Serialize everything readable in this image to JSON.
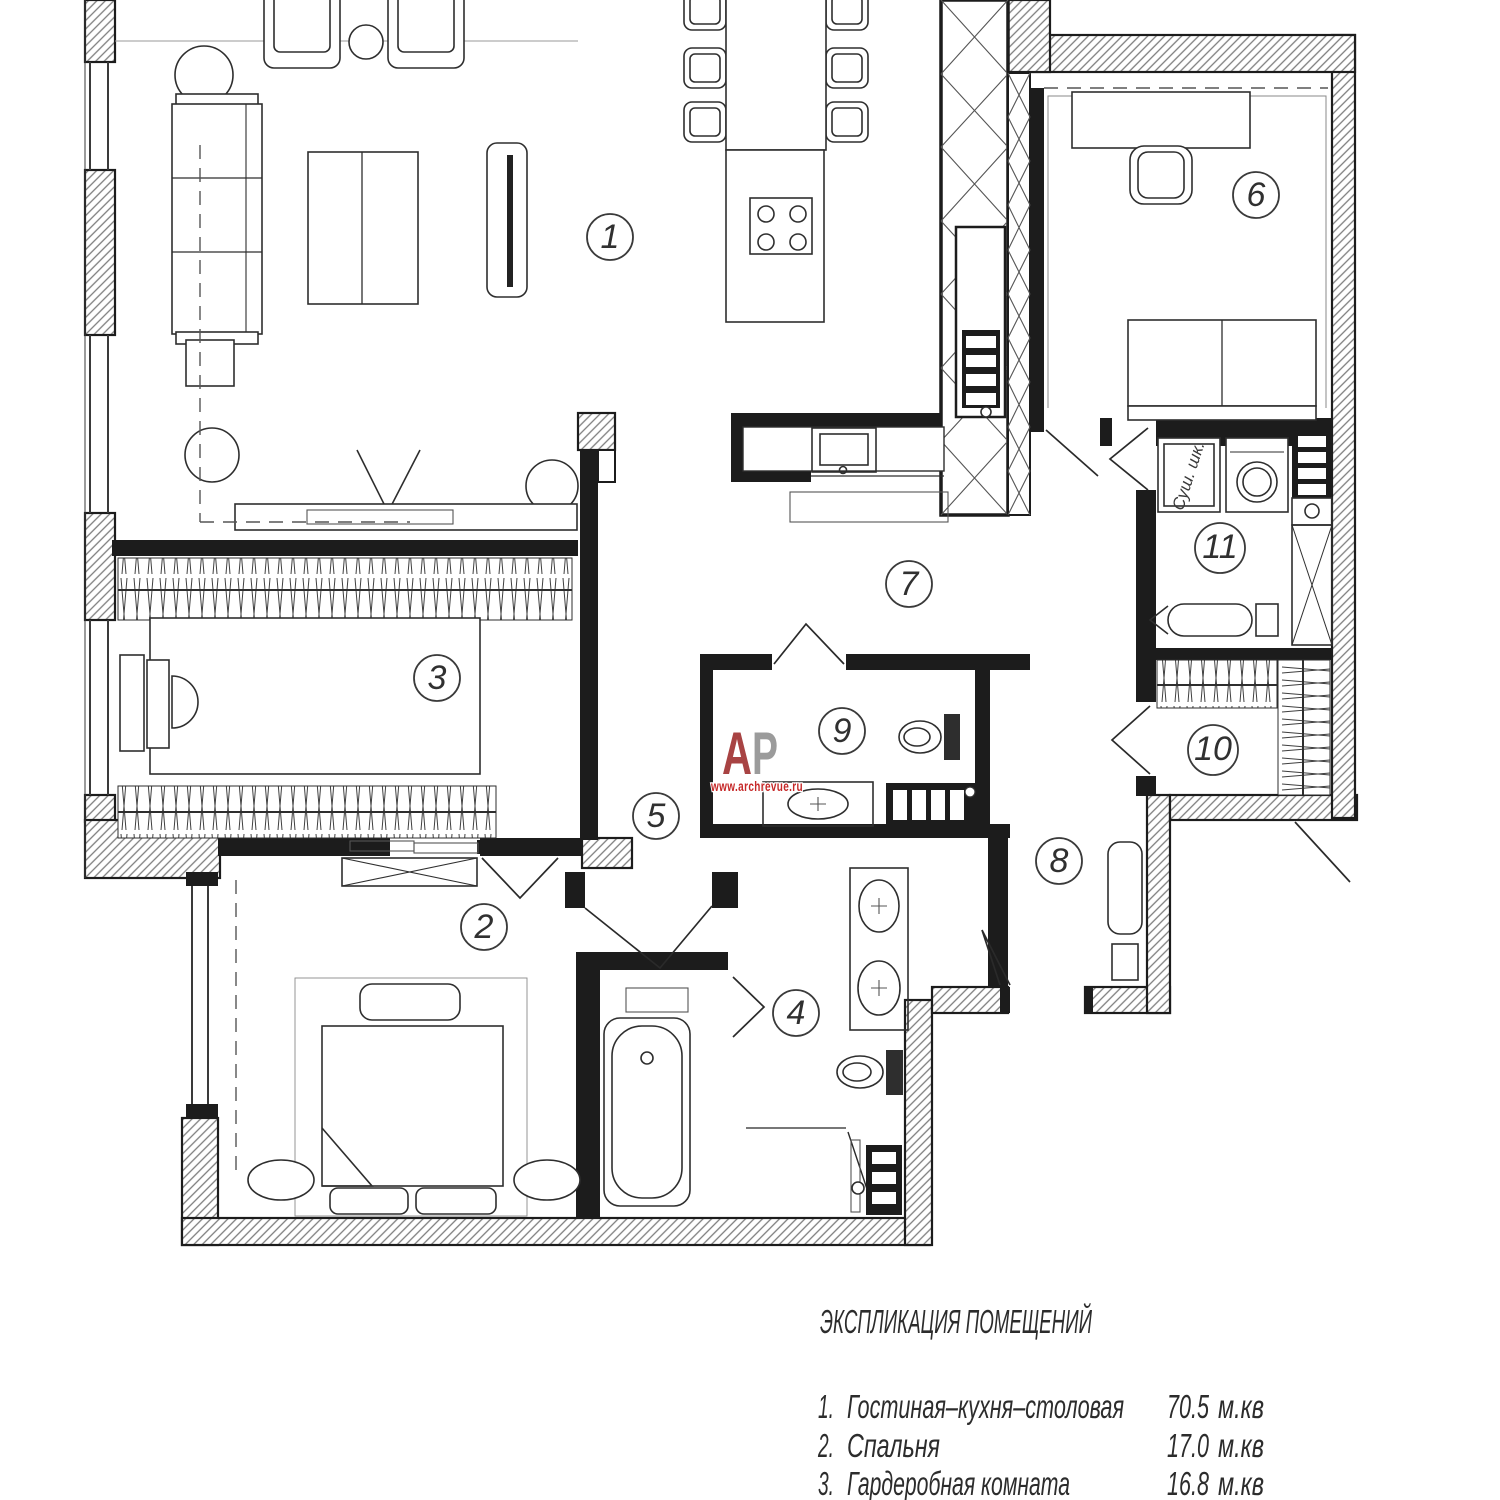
{
  "watermark": {
    "letter_a": "А",
    "letter_p": "Р",
    "url": "www.archrevue.ru",
    "color_a": "#a84343",
    "color_p": "#9b9b9b",
    "color_url": "#c62828"
  },
  "rooms": [
    {
      "number": "1"
    },
    {
      "number": "2"
    },
    {
      "number": "3"
    },
    {
      "number": "4"
    },
    {
      "number": "5"
    },
    {
      "number": "6"
    },
    {
      "number": "7"
    },
    {
      "number": "8"
    },
    {
      "number": "9"
    },
    {
      "number": "10"
    },
    {
      "number": "11"
    }
  ],
  "annotations": {
    "drying_cabinet": "Суш. шк."
  },
  "legend": {
    "title": "ЭКСПЛИКАЦИЯ ПОМЕЩЕНИЙ",
    "rows": [
      {
        "num": "1.",
        "name": "Гостиная–кухня–столовая",
        "area": "70.5",
        "unit": "м.кв"
      },
      {
        "num": "2.",
        "name": "Спальня",
        "area": "17.0",
        "unit": "м.кв"
      },
      {
        "num": "3.",
        "name": "Гардеробная комната",
        "area": "16.8",
        "unit": "м.кв"
      }
    ]
  },
  "colors": {
    "wall": "#1c1c1c",
    "line": "#2e2e2e",
    "hatch": "#7d7d7d"
  }
}
